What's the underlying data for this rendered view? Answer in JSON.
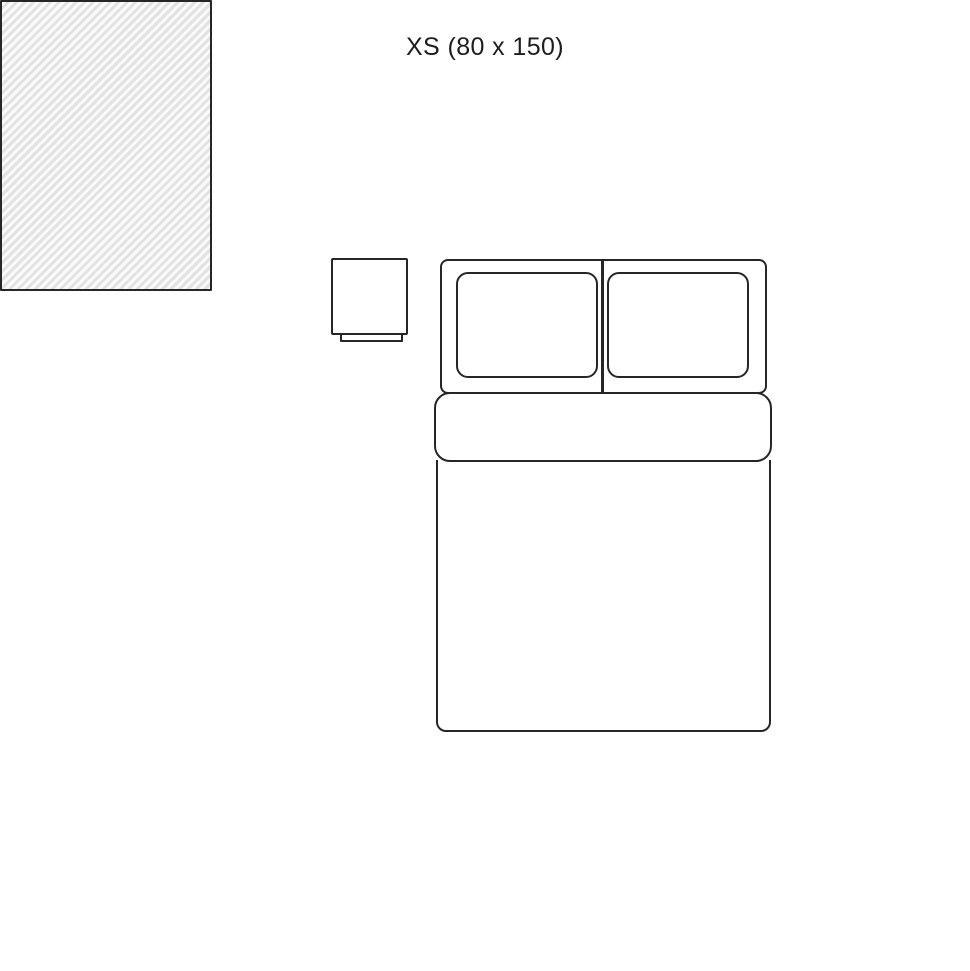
{
  "page": {
    "title": "XS (80 x 150)"
  },
  "colors": {
    "background": "#ffffff",
    "line": "#262626",
    "text": "#1d1d1d",
    "rug_base": "#fafafa",
    "rug_stripe": "#e2e2e2"
  },
  "elements": {
    "rug": "rug-xs-hatched",
    "bed": "double-bed-top-view",
    "nightstand": "nightstand-top-view"
  }
}
